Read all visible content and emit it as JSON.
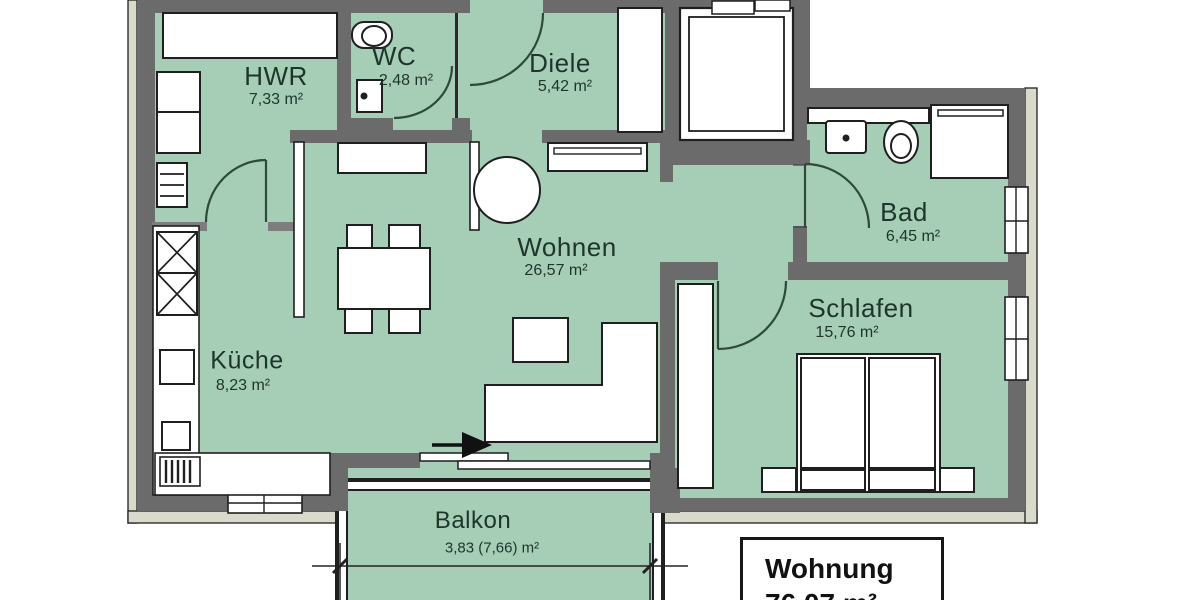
{
  "rooms": {
    "hwr": {
      "name": "HWR",
      "area": "7,33 m²"
    },
    "wc": {
      "name": "WC",
      "area": "2,48 m²"
    },
    "diele": {
      "name": "Diele",
      "area": "5,42 m²"
    },
    "bad": {
      "name": "Bad",
      "area": "6,45 m²"
    },
    "wohnen": {
      "name": "Wohnen",
      "area": "26,57 m²"
    },
    "schlafen": {
      "name": "Schlafen",
      "area": "15,76 m²"
    },
    "kueche": {
      "name": "Küche",
      "area": "8,23 m²"
    },
    "balkon": {
      "name": "Balkon",
      "area": "3,83 (7,66) m²"
    }
  },
  "summary": {
    "label": "Wohnung",
    "area": "76,07 m²"
  },
  "colors": {
    "floor_fill": "#a6cdb6",
    "wall": "#6b6b6b",
    "outer_trim": "#d9d9cc",
    "outline": "#1f1f1f",
    "door_arc": "#2d4a3a",
    "label_text": "#1d352b"
  }
}
